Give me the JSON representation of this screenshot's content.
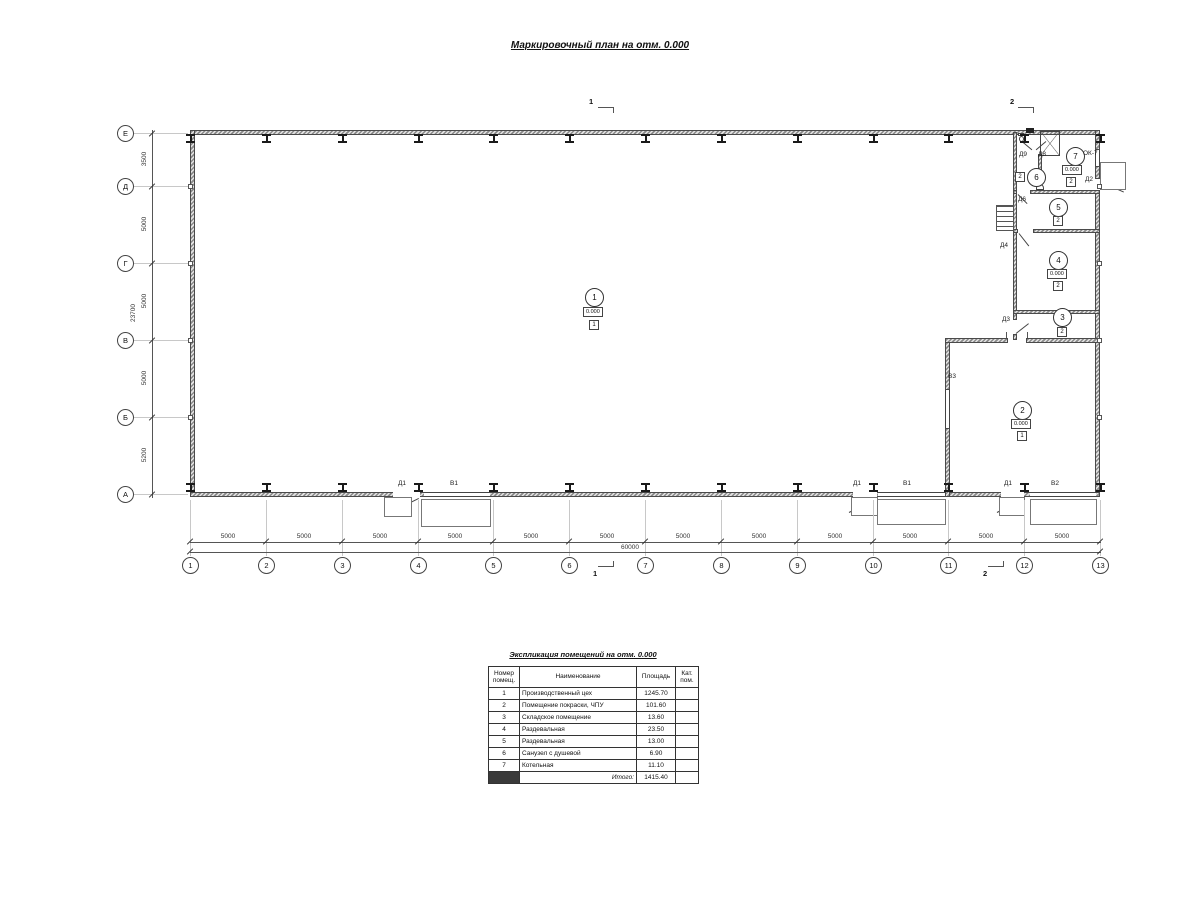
{
  "title": "Маркировочный план на отм. 0.000",
  "plan": {
    "axes_bottom": [
      "1",
      "2",
      "3",
      "4",
      "5",
      "6",
      "7",
      "8",
      "9",
      "10",
      "11",
      "12",
      "13"
    ],
    "axes_left": [
      "Е",
      "Д",
      "Г",
      "В",
      "Б",
      "А"
    ],
    "dims_bottom": [
      "5000",
      "5000",
      "5000",
      "5000",
      "5000",
      "5000",
      "5000",
      "5000",
      "5000",
      "5000",
      "5000",
      "5000"
    ],
    "dim_bottom_total": "60000",
    "dims_left": [
      "3500",
      "5000",
      "5000",
      "5000",
      "5200"
    ],
    "dim_left_total": "23700",
    "rooms": [
      {
        "num": "1",
        "elevation": "0.000",
        "category": "1"
      },
      {
        "num": "2",
        "elevation": "0.000",
        "category": "1"
      },
      {
        "num": "3",
        "category": "2"
      },
      {
        "num": "4",
        "elevation": "0.000",
        "category": "2"
      },
      {
        "num": "5",
        "category": "2"
      },
      {
        "num": "6",
        "category": "2"
      },
      {
        "num": "7",
        "elevation": "0.000",
        "category": "2"
      }
    ],
    "labels": {
      "d1": "Д1",
      "v1": "В1",
      "v2": "В2",
      "v3": "В3",
      "d2": "Д2",
      "d3": "Д3",
      "d4": "Д4",
      "d6": "Д6",
      "d8": "Д8",
      "d9": "Д9",
      "ok7": "ОК-7"
    },
    "section_marks": {
      "s1": "1",
      "s2": "2"
    }
  },
  "schedule": {
    "title": "Экспликация помещений на отм. 0.000",
    "headers": [
      "Номер помещ.",
      "Наименование",
      "Площадь",
      "Кат. пом."
    ],
    "rows": [
      [
        "1",
        "Производственный цех",
        "1245.70",
        ""
      ],
      [
        "2",
        "Помещение покраски, ЧПУ",
        "101.60",
        ""
      ],
      [
        "3",
        "Складское помещение",
        "13.60",
        ""
      ],
      [
        "4",
        "Раздевальная",
        "23.50",
        ""
      ],
      [
        "5",
        "Раздевальная",
        "13.00",
        ""
      ],
      [
        "6",
        "Санузел с душевой",
        "6.90",
        ""
      ],
      [
        "7",
        "Котельная",
        "11.10",
        ""
      ]
    ],
    "total_label": "Итого:",
    "total": "1415.40"
  }
}
